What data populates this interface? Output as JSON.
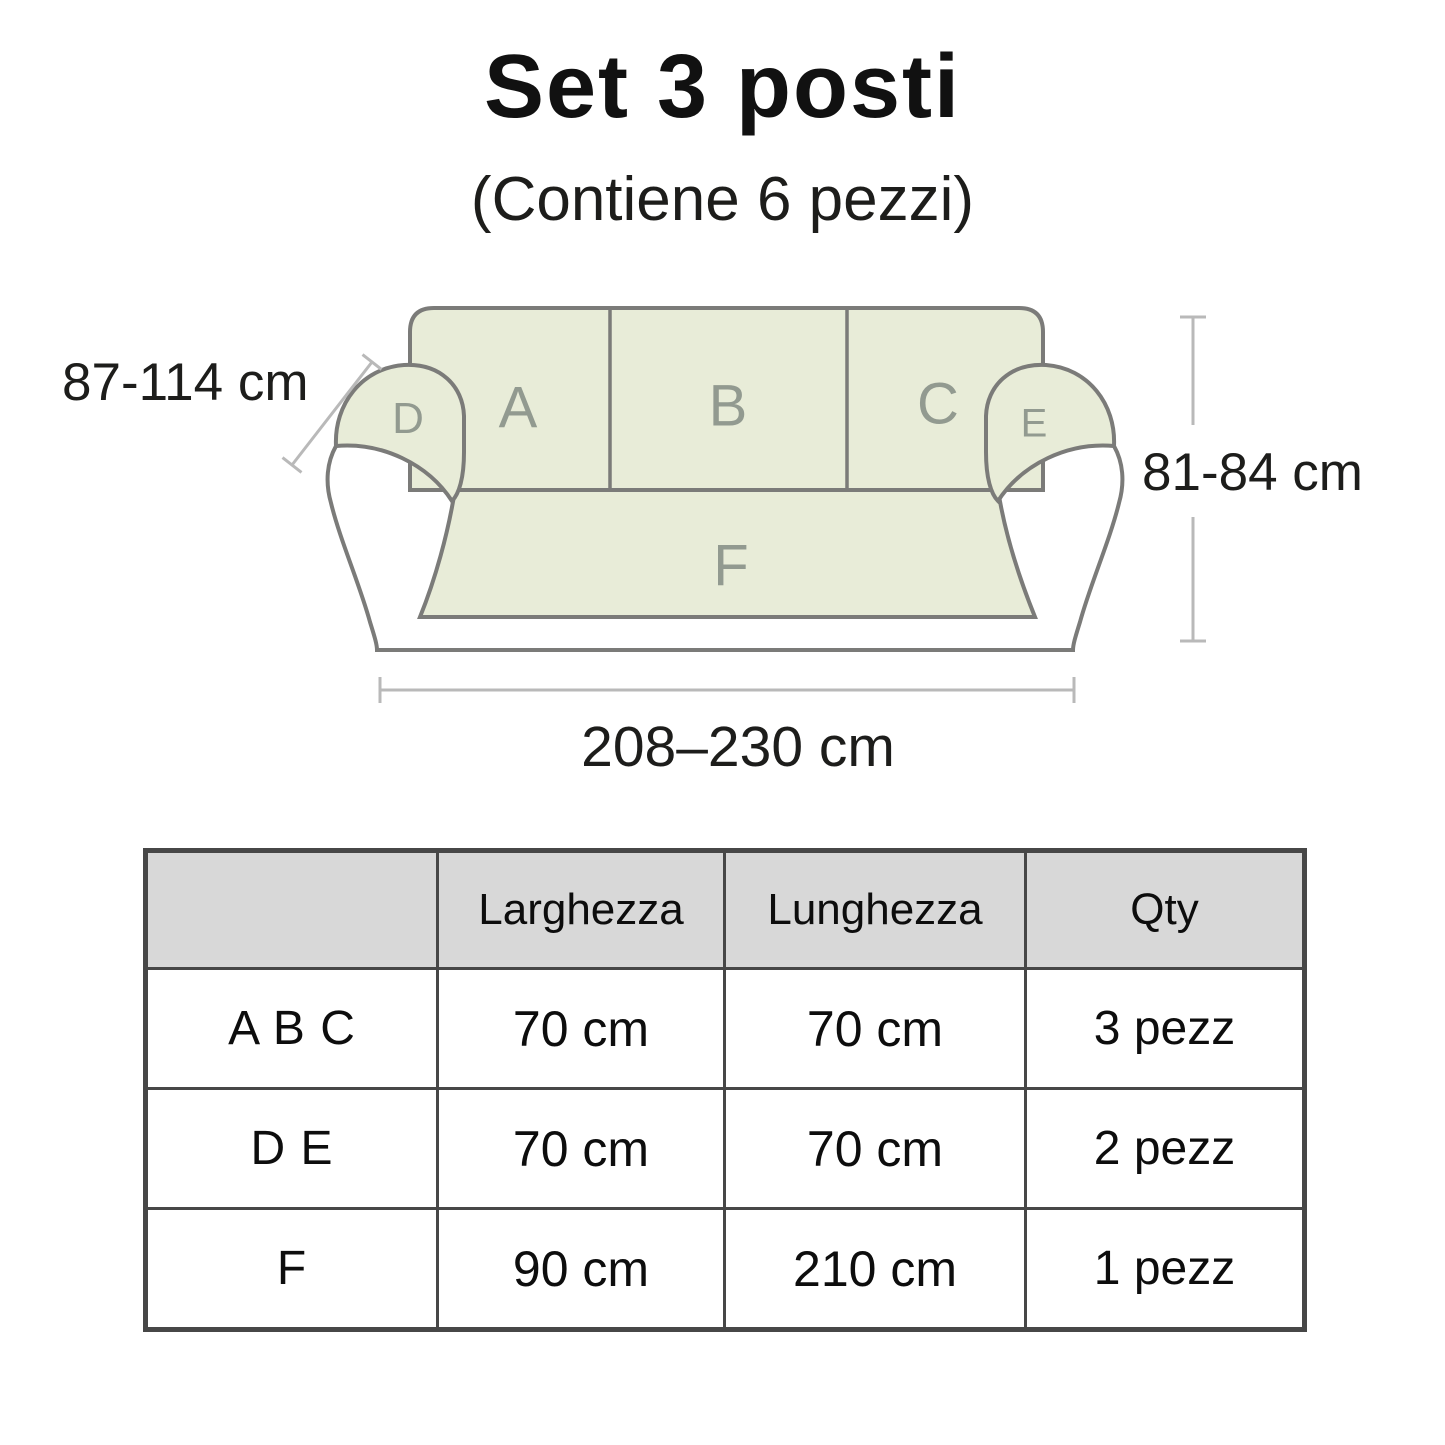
{
  "title": "Set 3 posti",
  "subtitle": "(Contiene 6 pezzi)",
  "diagram": {
    "sofa_sections": {
      "a": "A",
      "b": "B",
      "c": "C",
      "d": "D",
      "e": "E",
      "f": "F"
    },
    "dim_arm_depth": "87-114 cm",
    "dim_height": "81-84 cm",
    "dim_width": "208–230 cm",
    "colors": {
      "fabric": "#E8ECD8",
      "outline": "#7B7B79",
      "section_label": "#929A90",
      "measure_line": "#B9B9B9"
    }
  },
  "table": {
    "headers": [
      "",
      "Larghezza",
      "Lunghezza",
      "Qty"
    ],
    "rows": [
      [
        "A B C",
        "70 cm",
        "70 cm",
        "3 pezz"
      ],
      [
        "D E",
        "70 cm",
        "70 cm",
        "2 pezz"
      ],
      [
        "F",
        "90 cm",
        "210 cm",
        "1 pezz"
      ]
    ]
  }
}
